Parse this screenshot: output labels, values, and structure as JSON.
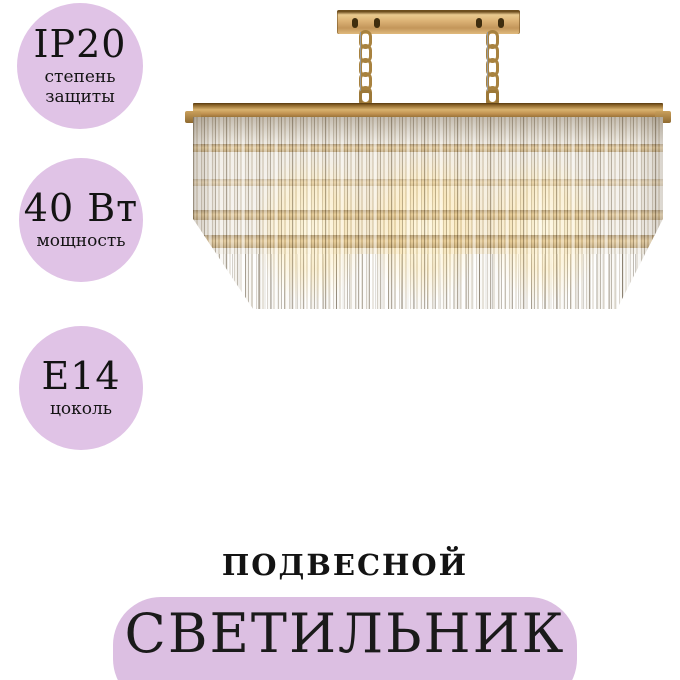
{
  "badges": [
    {
      "value": "IP20",
      "caption": "степень защиты"
    },
    {
      "value": "40 Вт",
      "caption": "мощность"
    },
    {
      "value": "E14",
      "caption": "цоколь"
    }
  ],
  "labels": {
    "type": "ПОДВЕСНОЙ",
    "name": "СВЕТИЛЬНИК"
  },
  "image": {
    "description": "crystal chandelier with gold rectangular frame, chains and ceiling plate, warm bulbs glowing"
  },
  "colors": {
    "badge_lavender": "#e0c3e6",
    "label_box_lavender": "#dcbfe2",
    "gold": "#c79a58",
    "text": "#131313",
    "background": "#ffffff"
  }
}
